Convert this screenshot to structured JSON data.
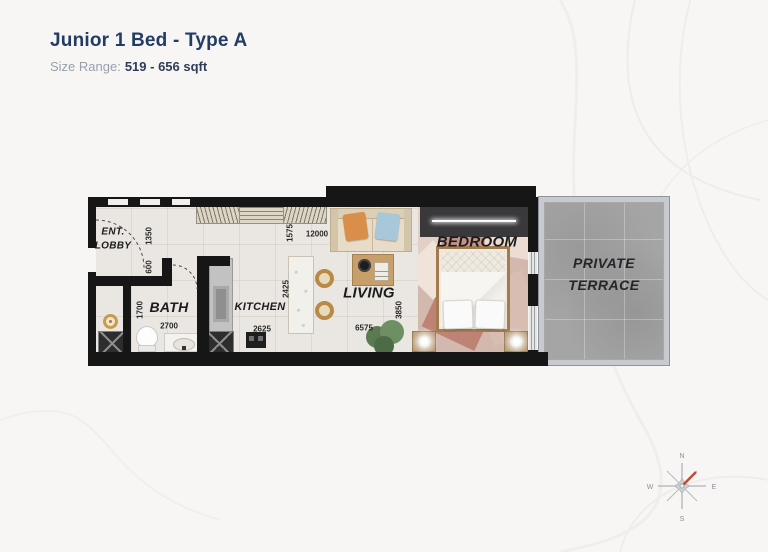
{
  "header": {
    "title": "Junior 1 Bed - Type A",
    "size_label": "Size Range:",
    "size_value": "519 - 656 sqft"
  },
  "rooms": {
    "lobby_line1": "ENT.",
    "lobby_line2": "LOBBY",
    "bath": "BATH",
    "kitchen": "KITCHEN",
    "living": "LIVING",
    "bedroom": "BEDROOM",
    "terrace_line1": "PRIVATE",
    "terrace_line2": "TERRACE"
  },
  "dimensions": {
    "lobby_width": "1350",
    "lobby_entry": "600",
    "bath_height": "1700",
    "bath_width": "2700",
    "kitchen_height": "2425",
    "kitchen_width": "2625",
    "wardrobe_depth": "1575",
    "total_width": "12000",
    "living_height": "3850",
    "living_width": "6575"
  },
  "compass": {
    "north": "N",
    "east": "E",
    "south": "S",
    "west": "W"
  },
  "colors": {
    "accent_navy": "#223c63",
    "muted_gray": "#97a0ad",
    "wall_black": "#161616",
    "terrace_gray": "#a5a5a5",
    "bedroom_rose": "#c59385",
    "wood_tan": "#c89f6b",
    "brass_gold": "#c08a3e",
    "compass_red": "#bf4b35"
  }
}
